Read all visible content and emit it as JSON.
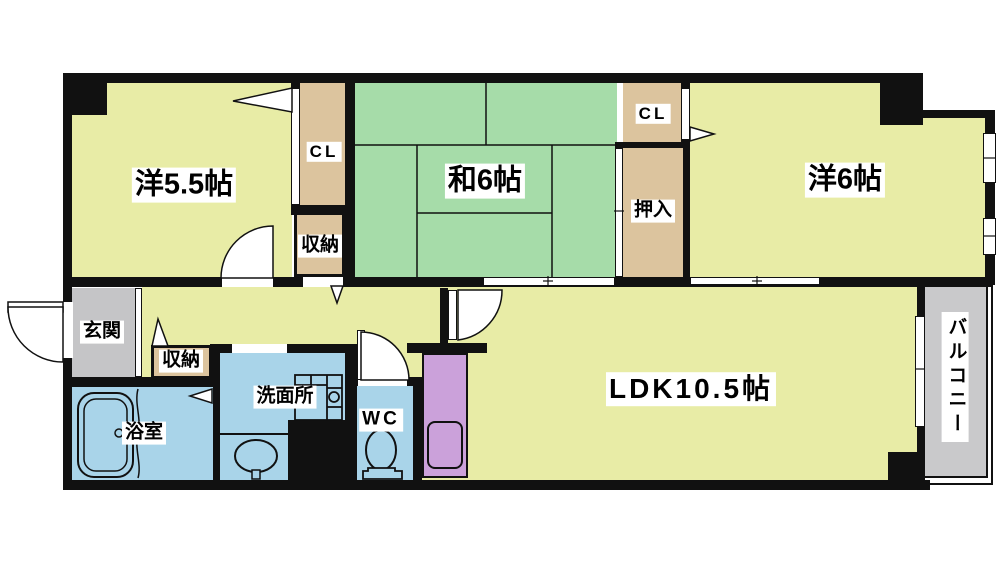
{
  "floorplan": {
    "rooms": {
      "western_room_small": {
        "label": "洋5.5帖"
      },
      "japanese_room": {
        "label": "和6帖"
      },
      "western_room_large": {
        "label": "洋6帖"
      },
      "ldk": {
        "label": "LDK10.5帖"
      },
      "entrance": {
        "label": "玄関"
      },
      "bathroom": {
        "label": "浴室"
      },
      "washroom": {
        "label": "洗面所"
      },
      "toilet": {
        "label": "WC"
      },
      "balcony": {
        "label": "バルコニー"
      },
      "closet_a": {
        "label": "CL"
      },
      "closet_b": {
        "label": "CL"
      },
      "oshiire": {
        "label": "押入"
      },
      "storage_a": {
        "label": "収納"
      },
      "storage_b": {
        "label": "収納"
      }
    },
    "colors": {
      "room_yellow": "#e8eca6",
      "tatami_green": "#a6dca9",
      "closet_beige": "#dcc49e",
      "entrance_gray": "#c5c5c7",
      "wet_area_blue": "#a9d4e9",
      "kitchen_purple": "#cba1da",
      "balcony_gray": "#c9c9cb",
      "wall_black": "#111111"
    }
  }
}
